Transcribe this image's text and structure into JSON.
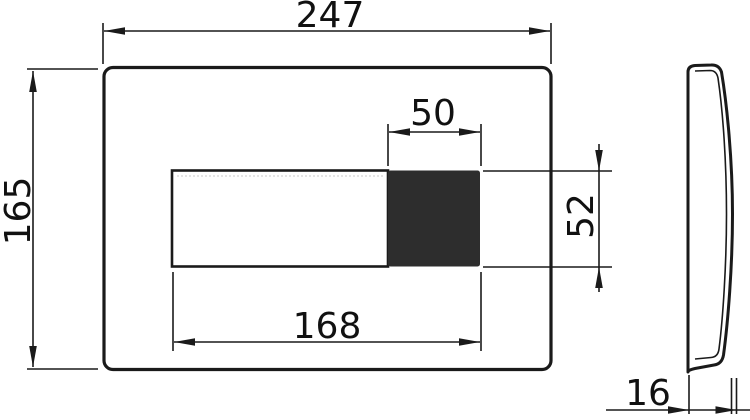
{
  "drawing": {
    "views": {
      "front": {
        "overall_width_mm": "247",
        "overall_height_mm": "165",
        "button_width_mm": "50",
        "button_height_mm": "52",
        "opening_width_mm": "168"
      },
      "side": {
        "depth_mm": "16"
      }
    },
    "colors": {
      "line": "#1a1a1a",
      "button_fill": "#2d2d2d",
      "background": "#ffffff"
    }
  }
}
